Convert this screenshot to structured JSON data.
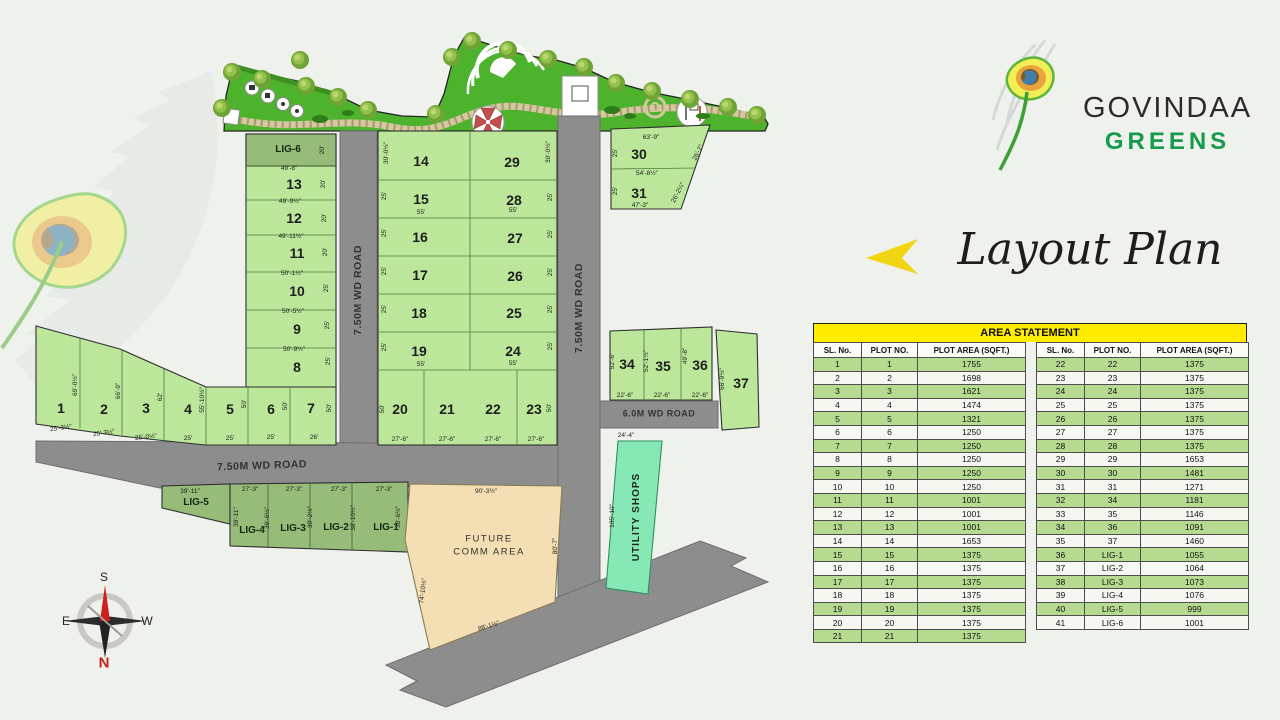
{
  "brand": {
    "line1": "GOVINDAA",
    "line2": "GREENS"
  },
  "page_title": "Layout Plan",
  "compass": {
    "top": "S",
    "left": "E",
    "right": "W",
    "bottom": "N"
  },
  "colors": {
    "plot_green": "#bce79b",
    "lig_green": "#97bb79",
    "garden_green": "#4db32c",
    "road_gray": "#8d8d8d",
    "utility_mint": "#86e8b4",
    "future_tan": "#f3dfb3",
    "table_green": "#b6db90",
    "header_yellow": "#ffec00",
    "brand_green": "#169a4c",
    "accent_yellow": "#f2d512",
    "north_red": "#c81c1c"
  },
  "area_statement": {
    "title": "AREA STATEMENT",
    "columns": [
      "SL. No.",
      "PLOT NO.",
      "PLOT AREA (SQFT.)"
    ],
    "left_rows": [
      [
        "1",
        "1",
        "1755"
      ],
      [
        "2",
        "2",
        "1698"
      ],
      [
        "3",
        "3",
        "1621"
      ],
      [
        "4",
        "4",
        "1474"
      ],
      [
        "5",
        "5",
        "1321"
      ],
      [
        "6",
        "6",
        "1250"
      ],
      [
        "7",
        "7",
        "1250"
      ],
      [
        "8",
        "8",
        "1250"
      ],
      [
        "9",
        "9",
        "1250"
      ],
      [
        "10",
        "10",
        "1250"
      ],
      [
        "11",
        "11",
        "1001"
      ],
      [
        "12",
        "12",
        "1001"
      ],
      [
        "13",
        "13",
        "1001"
      ],
      [
        "14",
        "14",
        "1653"
      ],
      [
        "15",
        "15",
        "1375"
      ],
      [
        "16",
        "16",
        "1375"
      ],
      [
        "17",
        "17",
        "1375"
      ],
      [
        "18",
        "18",
        "1375"
      ],
      [
        "19",
        "19",
        "1375"
      ],
      [
        "20",
        "20",
        "1375"
      ],
      [
        "21",
        "21",
        "1375"
      ]
    ],
    "right_rows": [
      [
        "22",
        "22",
        "1375"
      ],
      [
        "23",
        "23",
        "1375"
      ],
      [
        "24",
        "24",
        "1375"
      ],
      [
        "25",
        "25",
        "1375"
      ],
      [
        "26",
        "26",
        "1375"
      ],
      [
        "27",
        "27",
        "1375"
      ],
      [
        "28",
        "28",
        "1375"
      ],
      [
        "29",
        "29",
        "1653"
      ],
      [
        "30",
        "30",
        "1481"
      ],
      [
        "31",
        "31",
        "1271"
      ],
      [
        "32",
        "34",
        "1181"
      ],
      [
        "33",
        "35",
        "1146"
      ],
      [
        "34",
        "36",
        "1091"
      ],
      [
        "35",
        "37",
        "1460"
      ],
      [
        "36",
        "LIG-1",
        "1055"
      ],
      [
        "37",
        "LIG-2",
        "1064"
      ],
      [
        "38",
        "LIG-3",
        "1073"
      ],
      [
        "39",
        "LIG-4",
        "1076"
      ],
      [
        "40",
        "LIG-5",
        "999"
      ],
      [
        "41",
        "LIG-6",
        "1001"
      ]
    ]
  },
  "map": {
    "labels": [
      {
        "t": "7.50M WD ROAD",
        "x": 358,
        "y": 290,
        "r": -90,
        "k": "road",
        "n": "road-label-vertical-1"
      },
      {
        "t": "7.50M WD ROAD",
        "x": 579,
        "y": 308,
        "r": -90,
        "k": "road",
        "n": "road-label-vertical-2"
      },
      {
        "t": "7.50M WD ROAD",
        "x": 262,
        "y": 466,
        "r": -2,
        "k": "road",
        "n": "road-label-horizontal"
      },
      {
        "t": "6.0M WD ROAD",
        "x": 659,
        "y": 414,
        "k": "road6",
        "n": "road-label-6m"
      },
      {
        "t": "1",
        "x": 61,
        "y": 408,
        "k": "plot"
      },
      {
        "t": "2",
        "x": 104,
        "y": 409,
        "k": "plot"
      },
      {
        "t": "3",
        "x": 146,
        "y": 408,
        "k": "plot"
      },
      {
        "t": "4",
        "x": 188,
        "y": 409,
        "k": "plot"
      },
      {
        "t": "5",
        "x": 230,
        "y": 409,
        "k": "plot"
      },
      {
        "t": "6",
        "x": 271,
        "y": 409,
        "k": "plot"
      },
      {
        "t": "7",
        "x": 311,
        "y": 408,
        "k": "plot"
      },
      {
        "t": "8",
        "x": 297,
        "y": 367,
        "k": "plot"
      },
      {
        "t": "9",
        "x": 297,
        "y": 329,
        "k": "plot"
      },
      {
        "t": "10",
        "x": 297,
        "y": 291,
        "k": "plot"
      },
      {
        "t": "11",
        "x": 297,
        "y": 253,
        "k": "plot"
      },
      {
        "t": "12",
        "x": 294,
        "y": 218,
        "k": "plot"
      },
      {
        "t": "13",
        "x": 294,
        "y": 184,
        "k": "plot"
      },
      {
        "t": "14",
        "x": 421,
        "y": 161,
        "k": "plot"
      },
      {
        "t": "15",
        "x": 421,
        "y": 199,
        "k": "plot"
      },
      {
        "t": "16",
        "x": 420,
        "y": 237,
        "k": "plot"
      },
      {
        "t": "17",
        "x": 420,
        "y": 275,
        "k": "plot"
      },
      {
        "t": "18",
        "x": 419,
        "y": 313,
        "k": "plot"
      },
      {
        "t": "19",
        "x": 419,
        "y": 351,
        "k": "plot"
      },
      {
        "t": "20",
        "x": 400,
        "y": 409,
        "k": "plot"
      },
      {
        "t": "21",
        "x": 447,
        "y": 409,
        "k": "plot"
      },
      {
        "t": "22",
        "x": 493,
        "y": 409,
        "k": "plot"
      },
      {
        "t": "23",
        "x": 534,
        "y": 409,
        "k": "plot"
      },
      {
        "t": "24",
        "x": 513,
        "y": 351,
        "k": "plot"
      },
      {
        "t": "25",
        "x": 514,
        "y": 313,
        "k": "plot"
      },
      {
        "t": "26",
        "x": 515,
        "y": 276,
        "k": "plot"
      },
      {
        "t": "27",
        "x": 515,
        "y": 238,
        "k": "plot"
      },
      {
        "t": "28",
        "x": 514,
        "y": 200,
        "k": "plot"
      },
      {
        "t": "29",
        "x": 512,
        "y": 162,
        "k": "plot"
      },
      {
        "t": "30",
        "x": 639,
        "y": 154,
        "k": "plot"
      },
      {
        "t": "31",
        "x": 639,
        "y": 193,
        "k": "plot"
      },
      {
        "t": "34",
        "x": 627,
        "y": 364,
        "k": "plot"
      },
      {
        "t": "35",
        "x": 663,
        "y": 366,
        "k": "plot"
      },
      {
        "t": "36",
        "x": 700,
        "y": 365,
        "k": "plot"
      },
      {
        "t": "37",
        "x": 741,
        "y": 383,
        "k": "plot"
      },
      {
        "t": "LIG-6",
        "x": 288,
        "y": 150,
        "k": "lig"
      },
      {
        "t": "LIG-5",
        "x": 196,
        "y": 503,
        "k": "lig"
      },
      {
        "t": "LIG-4",
        "x": 252,
        "y": 531,
        "k": "lig"
      },
      {
        "t": "LIG-3",
        "x": 293,
        "y": 529,
        "k": "lig"
      },
      {
        "t": "LIG-2",
        "x": 336,
        "y": 528,
        "k": "lig"
      },
      {
        "t": "LIG-1",
        "x": 386,
        "y": 528,
        "k": "lig"
      },
      {
        "t": "FUTURE",
        "x": 489,
        "y": 539,
        "k": "area"
      },
      {
        "t": "COMM AREA",
        "x": 489,
        "y": 552,
        "k": "area"
      },
      {
        "t": "UTILITY SHOPS",
        "x": 637,
        "y": 517,
        "r": -90,
        "k": "util"
      },
      {
        "t": "49'-8\"",
        "x": 289,
        "y": 169,
        "k": "dim"
      },
      {
        "t": "49'-9½\"",
        "x": 290,
        "y": 202,
        "k": "dim"
      },
      {
        "t": "49'-11½\"",
        "x": 291,
        "y": 237,
        "k": "dim"
      },
      {
        "t": "50'-1½\"",
        "x": 292,
        "y": 274,
        "k": "dim"
      },
      {
        "t": "50'-5½\"",
        "x": 293,
        "y": 312,
        "k": "dim"
      },
      {
        "t": "50'-9½\"",
        "x": 294,
        "y": 350,
        "k": "dim"
      },
      {
        "t": "20'",
        "x": 323,
        "y": 150,
        "r": -90,
        "k": "dim"
      },
      {
        "t": "20'",
        "x": 324,
        "y": 184,
        "r": -90,
        "k": "dim"
      },
      {
        "t": "20'",
        "x": 325,
        "y": 218,
        "r": -90,
        "k": "dim"
      },
      {
        "t": "20'",
        "x": 326,
        "y": 252,
        "r": -90,
        "k": "dim"
      },
      {
        "t": "25'",
        "x": 327,
        "y": 288,
        "r": -90,
        "k": "dim"
      },
      {
        "t": "25'",
        "x": 328,
        "y": 325,
        "r": -90,
        "k": "dim"
      },
      {
        "t": "25'",
        "x": 329,
        "y": 361,
        "r": -90,
        "k": "dim"
      },
      {
        "t": "30'-0½\"",
        "x": 387,
        "y": 153,
        "r": -90,
        "k": "dim"
      },
      {
        "t": "30'-0½\"",
        "x": 549,
        "y": 152,
        "r": -90,
        "k": "dim"
      },
      {
        "t": "25'",
        "x": 385,
        "y": 196,
        "r": -90,
        "k": "dim"
      },
      {
        "t": "25'",
        "x": 385,
        "y": 233,
        "r": -90,
        "k": "dim"
      },
      {
        "t": "25'",
        "x": 385,
        "y": 271,
        "r": -90,
        "k": "dim"
      },
      {
        "t": "25'",
        "x": 385,
        "y": 309,
        "r": -90,
        "k": "dim"
      },
      {
        "t": "25'",
        "x": 385,
        "y": 347,
        "r": -90,
        "k": "dim"
      },
      {
        "t": "25'",
        "x": 551,
        "y": 197,
        "r": -90,
        "k": "dim"
      },
      {
        "t": "25'",
        "x": 551,
        "y": 234,
        "r": -90,
        "k": "dim"
      },
      {
        "t": "25'",
        "x": 551,
        "y": 272,
        "r": -90,
        "k": "dim"
      },
      {
        "t": "25'",
        "x": 551,
        "y": 309,
        "r": -90,
        "k": "dim"
      },
      {
        "t": "25'",
        "x": 551,
        "y": 346,
        "r": -90,
        "k": "dim"
      },
      {
        "t": "55'",
        "x": 421,
        "y": 213,
        "k": "dim"
      },
      {
        "t": "55'",
        "x": 513,
        "y": 211,
        "k": "dim"
      },
      {
        "t": "55'",
        "x": 421,
        "y": 365,
        "k": "dim"
      },
      {
        "t": "55'",
        "x": 513,
        "y": 364,
        "k": "dim"
      },
      {
        "t": "50'",
        "x": 383,
        "y": 409,
        "r": -90,
        "k": "dim"
      },
      {
        "t": "50'",
        "x": 550,
        "y": 408,
        "r": -90,
        "k": "dim"
      },
      {
        "t": "27'-6\"",
        "x": 400,
        "y": 440,
        "k": "dim"
      },
      {
        "t": "27'-6\"",
        "x": 447,
        "y": 440,
        "k": "dim"
      },
      {
        "t": "27'-6\"",
        "x": 493,
        "y": 440,
        "k": "dim"
      },
      {
        "t": "27'-6\"",
        "x": 536,
        "y": 440,
        "k": "dim"
      },
      {
        "t": "69'-0½\"",
        "x": 76,
        "y": 385,
        "r": -90,
        "k": "dim"
      },
      {
        "t": "66'-9\"",
        "x": 119,
        "y": 391,
        "r": -90,
        "k": "dim"
      },
      {
        "t": "62'",
        "x": 161,
        "y": 397,
        "r": -90,
        "k": "dim"
      },
      {
        "t": "55'-10½\"",
        "x": 203,
        "y": 400,
        "r": -90,
        "k": "dim"
      },
      {
        "t": "50'",
        "x": 245,
        "y": 404,
        "r": -90,
        "k": "dim"
      },
      {
        "t": "50'",
        "x": 286,
        "y": 406,
        "r": -90,
        "k": "dim"
      },
      {
        "t": "50'",
        "x": 330,
        "y": 408,
        "r": -90,
        "k": "dim"
      },
      {
        "t": "25'-3½\"",
        "x": 61,
        "y": 429,
        "r": -8,
        "k": "dim"
      },
      {
        "t": "25'-3½\"",
        "x": 104,
        "y": 434,
        "r": -8,
        "k": "dim"
      },
      {
        "t": "25'-0½\"",
        "x": 146,
        "y": 438,
        "r": -6,
        "k": "dim"
      },
      {
        "t": "25'",
        "x": 188,
        "y": 439,
        "k": "dim"
      },
      {
        "t": "25'",
        "x": 230,
        "y": 439,
        "k": "dim"
      },
      {
        "t": "25'",
        "x": 271,
        "y": 438,
        "k": "dim"
      },
      {
        "t": "26'",
        "x": 314,
        "y": 438,
        "k": "dim"
      },
      {
        "t": "63'-9\"",
        "x": 651,
        "y": 138,
        "k": "dim"
      },
      {
        "t": "54'-8½\"",
        "x": 647,
        "y": 174,
        "k": "dim"
      },
      {
        "t": "47'-3\"",
        "x": 640,
        "y": 206,
        "k": "dim"
      },
      {
        "t": "25'",
        "x": 616,
        "y": 153,
        "r": -90,
        "k": "dim"
      },
      {
        "t": "25'",
        "x": 616,
        "y": 191,
        "r": -90,
        "k": "dim"
      },
      {
        "t": "26'-7\"",
        "x": 699,
        "y": 153,
        "r": -63,
        "k": "dim"
      },
      {
        "t": "26'-2¼\"",
        "x": 679,
        "y": 193,
        "r": -63,
        "k": "dim"
      },
      {
        "t": "52'-6\"",
        "x": 613,
        "y": 361,
        "r": -90,
        "k": "dim"
      },
      {
        "t": "52'-1½\"",
        "x": 647,
        "y": 361,
        "r": -90,
        "k": "dim"
      },
      {
        "t": "49'-8\"",
        "x": 686,
        "y": 356,
        "r": -90,
        "k": "dim"
      },
      {
        "t": "66'-9½\"",
        "x": 723,
        "y": 379,
        "r": -90,
        "k": "dim"
      },
      {
        "t": "22'-6\"",
        "x": 625,
        "y": 396,
        "k": "dim"
      },
      {
        "t": "22'-6\"",
        "x": 662,
        "y": 396,
        "k": "dim"
      },
      {
        "t": "22'-6\"",
        "x": 700,
        "y": 396,
        "k": "dim"
      },
      {
        "t": "24'-4\"",
        "x": 626,
        "y": 436,
        "k": "dim"
      },
      {
        "t": "39'-11\"",
        "x": 190,
        "y": 492,
        "k": "dim"
      },
      {
        "t": "27'-3\"",
        "x": 250,
        "y": 490,
        "k": "dim"
      },
      {
        "t": "27'-3\"",
        "x": 294,
        "y": 490,
        "k": "dim"
      },
      {
        "t": "27'-3\"",
        "x": 339,
        "y": 490,
        "k": "dim"
      },
      {
        "t": "27'-3\"",
        "x": 384,
        "y": 490,
        "k": "dim"
      },
      {
        "t": "39'-11\"",
        "x": 237,
        "y": 517,
        "r": -90,
        "k": "dim"
      },
      {
        "t": "39'-6½\"",
        "x": 268,
        "y": 518,
        "r": -90,
        "k": "dim"
      },
      {
        "t": "39'-2½\"",
        "x": 311,
        "y": 517,
        "r": -90,
        "k": "dim"
      },
      {
        "t": "38'-10½\"",
        "x": 354,
        "y": 518,
        "r": -90,
        "k": "dim"
      },
      {
        "t": "38'-6½\"",
        "x": 399,
        "y": 517,
        "r": -90,
        "k": "dim"
      },
      {
        "t": "90'-3½\"",
        "x": 486,
        "y": 492,
        "k": "dim"
      },
      {
        "t": "80'-7\"",
        "x": 556,
        "y": 546,
        "r": -90,
        "k": "dim"
      },
      {
        "t": "88'-1½\"",
        "x": 489,
        "y": 627,
        "r": -17,
        "k": "dim"
      },
      {
        "t": "74'-10½\"",
        "x": 424,
        "y": 591,
        "r": -83,
        "k": "dim"
      },
      {
        "t": "105'-10\"",
        "x": 613,
        "y": 516,
        "r": -90,
        "k": "dim"
      },
      {
        "t": "S",
        "x": 104,
        "y": 577,
        "k": "comp",
        "n": "compass-south-label"
      },
      {
        "t": "E",
        "x": 66,
        "y": 621,
        "k": "comp",
        "n": "compass-east-label"
      },
      {
        "t": "W",
        "x": 147,
        "y": 621,
        "k": "comp",
        "n": "compass-west-label"
      },
      {
        "t": "N",
        "x": 104,
        "y": 663,
        "k": "compN",
        "n": "compass-north-label"
      }
    ]
  }
}
